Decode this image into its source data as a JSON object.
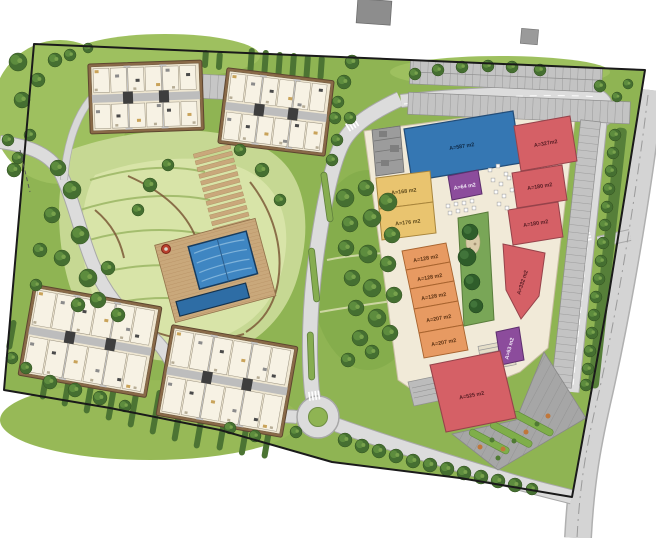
{
  "plan": {
    "type": "site-master-plan",
    "zones": {
      "residential": "apartment blocks with central landscaped park and pools",
      "commercial": "retail center with parking"
    }
  },
  "colors": {
    "anchor_blue": "#3577b3",
    "retail_red": "#d56066",
    "retail_yellow": "#e9c46f",
    "retail_orange": "#e79a62",
    "kiosk_purple": "#8c4c9c",
    "plaza_cream": "#f1ead8",
    "road_gray": "#dcdcdc",
    "grass_green": "#8fb453",
    "service_gray": "#9c9c9c",
    "pool_blue": "#3f86c2"
  },
  "commercial": {
    "units": [
      {
        "name": "anchor-store",
        "label": "A=587 m2",
        "category": "anchor_blue"
      },
      {
        "name": "retail-red-1",
        "label": "A=327m2",
        "category": "retail_red"
      },
      {
        "name": "retail-red-2",
        "label": "A=180 m2",
        "category": "retail_red"
      },
      {
        "name": "retail-red-3",
        "label": "A=180 m2",
        "category": "retail_red"
      },
      {
        "name": "retail-yellow-1",
        "label": "A=168 m2",
        "category": "retail_yellow"
      },
      {
        "name": "retail-yellow-2",
        "label": "A=176 m2",
        "category": "retail_yellow"
      },
      {
        "name": "kiosk-1",
        "label": "A=64 m2",
        "category": "kiosk_purple"
      },
      {
        "name": "retail-orange-1",
        "label": "A=128 m2",
        "category": "retail_orange"
      },
      {
        "name": "retail-orange-2",
        "label": "A=128 m2",
        "category": "retail_orange"
      },
      {
        "name": "retail-orange-3",
        "label": "A=128 m2",
        "category": "retail_orange"
      },
      {
        "name": "retail-orange-4",
        "label": "A=207 m2",
        "category": "retail_orange"
      },
      {
        "name": "retail-orange-5",
        "label": "A=207 m2",
        "category": "retail_orange"
      },
      {
        "name": "retail-red-4",
        "label": "A=332 m2",
        "category": "retail_red"
      },
      {
        "name": "kiosk-2",
        "label": "A=63 m2",
        "category": "kiosk_purple"
      },
      {
        "name": "retail-red-5",
        "label": "A=525 m2",
        "category": "retail_red"
      }
    ]
  }
}
